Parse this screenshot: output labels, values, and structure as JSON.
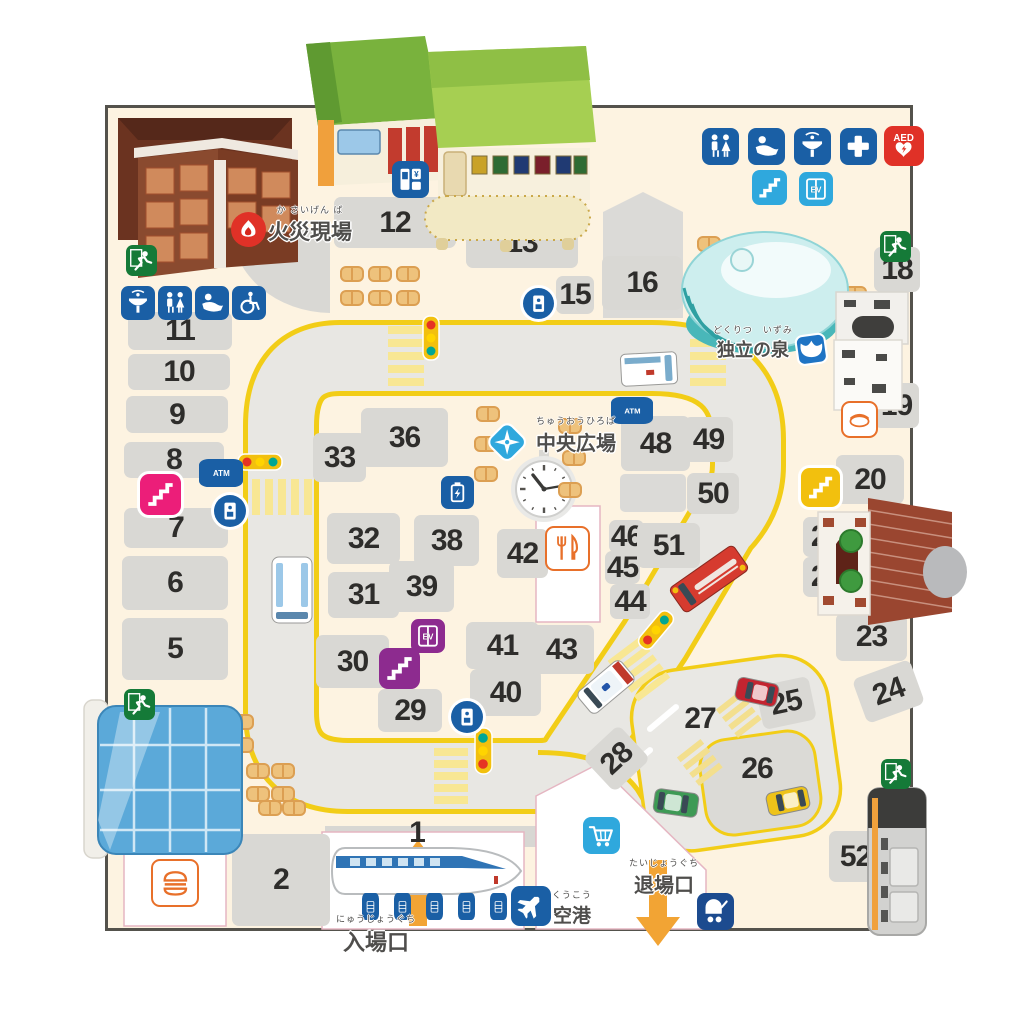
{
  "labels": {
    "fire": {
      "furigana": "か さいげん ば",
      "text": "火災現場"
    },
    "fountain": {
      "furigana": "どくりつ　いずみ",
      "text": "独立の泉"
    },
    "plaza": {
      "furigana": "ちゅうおうひろば",
      "text": "中央広場"
    },
    "entrance": {
      "furigana": "にゅうじょうぐち",
      "text": "入場口"
    },
    "exit": {
      "furigana": "たいじょうぐち",
      "text": "退場口"
    },
    "airport": {
      "furigana": "くうこう",
      "text": "空港"
    }
  },
  "board": {
    "colors": {
      "board_bg": "#fdf3e1",
      "cell_gray": "#d9d8d4",
      "road_gray": "#e8e7e3",
      "road_line_yellow": "#f2cd17",
      "crosswalk_yellow": "#f8e793",
      "icon_blue": "#1a5fa5",
      "icon_lightblue": "#2fa8dd",
      "icon_navy": "#1c4b8f",
      "icon_purple": "#8d2b8f",
      "icon_pink": "#ec1e79",
      "icon_yellow": "#f2c00e",
      "exit_green": "#157a38",
      "aed_red": "#e03127",
      "accent_orange": "#f2a434",
      "chip_orange": "#e8702a",
      "zone_border_pink": "#e5b6c2"
    },
    "spaces": [
      {
        "n": "1",
        "bare": true,
        "cx": 417,
        "cy": 833
      },
      {
        "n": "2",
        "x": 232,
        "y": 834,
        "w": 98,
        "h": 92
      },
      {
        "n": "3",
        "x": 138,
        "y": 790,
        "w": 58,
        "h": 42
      },
      {
        "n": "4",
        "x": 140,
        "y": 716,
        "w": 62,
        "h": 48
      },
      {
        "n": "5",
        "x": 122,
        "y": 618,
        "w": 106,
        "h": 62
      },
      {
        "n": "6",
        "x": 122,
        "y": 556,
        "w": 106,
        "h": 54
      },
      {
        "n": "7",
        "x": 124,
        "y": 508,
        "w": 104,
        "h": 40
      },
      {
        "n": "8",
        "x": 124,
        "y": 442,
        "w": 100,
        "h": 36
      },
      {
        "n": "9",
        "x": 126,
        "y": 396,
        "w": 102,
        "h": 37
      },
      {
        "n": "10",
        "x": 128,
        "y": 354,
        "w": 102,
        "h": 36
      },
      {
        "n": "11",
        "x": 128,
        "y": 312,
        "w": 104,
        "h": 38
      },
      {
        "n": "12",
        "x": 334,
        "y": 197,
        "w": 122,
        "h": 51
      },
      {
        "n": "13",
        "x": 466,
        "y": 218,
        "w": 112,
        "h": 50
      },
      {
        "n": "15",
        "x": 556,
        "y": 276,
        "w": 38,
        "h": 38
      },
      {
        "n": "16",
        "x": 602,
        "y": 256,
        "w": 80,
        "h": 54
      },
      {
        "n": "18",
        "x": 874,
        "y": 247,
        "w": 46,
        "h": 45
      },
      {
        "n": "19",
        "x": 874,
        "y": 383,
        "w": 45,
        "h": 45
      },
      {
        "n": "20",
        "x": 836,
        "y": 455,
        "w": 68,
        "h": 49
      },
      {
        "n": "21",
        "x": 803,
        "y": 517,
        "w": 47,
        "h": 40
      },
      {
        "n": "22",
        "x": 803,
        "y": 557,
        "w": 47,
        "h": 40
      },
      {
        "n": "23",
        "x": 836,
        "y": 613,
        "w": 71,
        "h": 48
      },
      {
        "n": "24",
        "x": 858,
        "y": 668,
        "w": 61,
        "h": 47,
        "rot": -20
      },
      {
        "n": "25",
        "x": 759,
        "y": 681,
        "w": 54,
        "h": 44,
        "rot": -12
      },
      {
        "n": "26",
        "bare": true,
        "cx": 757,
        "cy": 769
      },
      {
        "n": "27",
        "bare": true,
        "cx": 700,
        "cy": 719
      },
      {
        "n": "28",
        "x": 592,
        "y": 735,
        "w": 49,
        "h": 47,
        "rot": -43
      },
      {
        "n": "29",
        "x": 378,
        "y": 689,
        "w": 64,
        "h": 43
      },
      {
        "n": "30",
        "x": 316,
        "y": 635,
        "w": 73,
        "h": 53
      },
      {
        "n": "31",
        "x": 328,
        "y": 572,
        "w": 71,
        "h": 46
      },
      {
        "n": "32",
        "x": 327,
        "y": 513,
        "w": 73,
        "h": 51
      },
      {
        "n": "33",
        "x": 313,
        "y": 433,
        "w": 53,
        "h": 49
      },
      {
        "n": "36",
        "x": 361,
        "y": 408,
        "w": 87,
        "h": 59
      },
      {
        "n": "38",
        "x": 414,
        "y": 515,
        "w": 65,
        "h": 51
      },
      {
        "n": "39",
        "x": 389,
        "y": 561,
        "w": 65,
        "h": 51
      },
      {
        "n": "40",
        "x": 470,
        "y": 669,
        "w": 71,
        "h": 47
      },
      {
        "n": "41",
        "x": 466,
        "y": 622,
        "w": 73,
        "h": 47
      },
      {
        "n": "42",
        "x": 497,
        "y": 529,
        "w": 51,
        "h": 49
      },
      {
        "n": "43",
        "x": 529,
        "y": 625,
        "w": 65,
        "h": 49
      },
      {
        "n": "44",
        "x": 610,
        "y": 584,
        "w": 40,
        "h": 35
      },
      {
        "n": "45",
        "x": 605,
        "y": 551,
        "w": 35,
        "h": 33
      },
      {
        "n": "46",
        "x": 609,
        "y": 520,
        "w": 35,
        "h": 33
      },
      {
        "n": "48",
        "x": 621,
        "y": 416,
        "w": 69,
        "h": 55
      },
      {
        "n": "49",
        "x": 684,
        "y": 417,
        "w": 49,
        "h": 45
      },
      {
        "n": "50",
        "x": 687,
        "y": 473,
        "w": 52,
        "h": 41
      },
      {
        "n": "51",
        "x": 637,
        "y": 523,
        "w": 63,
        "h": 45
      },
      {
        "n": "52",
        "x": 829,
        "y": 831,
        "w": 53,
        "h": 51
      }
    ],
    "icons": [
      {
        "t": "toilet",
        "x": 702,
        "y": 128,
        "s": 37
      },
      {
        "t": "nursing",
        "x": 748,
        "y": 128,
        "s": 37
      },
      {
        "t": "drink-fountain",
        "x": 794,
        "y": 128,
        "s": 37
      },
      {
        "t": "first-aid",
        "x": 840,
        "y": 128,
        "s": 37
      },
      {
        "t": "aed",
        "x": 884,
        "y": 126,
        "s": 40,
        "bg": "red"
      },
      {
        "t": "stairs",
        "x": 752,
        "y": 170,
        "s": 35,
        "bg": "lightblue"
      },
      {
        "t": "elevator",
        "x": 799,
        "y": 172,
        "s": 34,
        "bg": "lightblue"
      },
      {
        "t": "exit-run",
        "x": 880,
        "y": 231,
        "s": 31,
        "bg": "green"
      },
      {
        "t": "exit-run",
        "x": 126,
        "y": 245,
        "s": 31,
        "bg": "green"
      },
      {
        "t": "drink-fountain",
        "x": 121,
        "y": 286,
        "s": 34
      },
      {
        "t": "toilet",
        "x": 158,
        "y": 286,
        "s": 34
      },
      {
        "t": "nursing",
        "x": 195,
        "y": 286,
        "s": 34
      },
      {
        "t": "wheelchair",
        "x": 232,
        "y": 286,
        "s": 34
      },
      {
        "t": "fire-badge",
        "x": 231,
        "y": 212,
        "s": 35,
        "bg": "red"
      },
      {
        "t": "vending",
        "x": 392,
        "y": 161,
        "s": 37
      },
      {
        "t": "phone",
        "x": 523,
        "y": 288,
        "s": 31
      },
      {
        "t": "atm",
        "x": 199,
        "y": 459,
        "w": 44,
        "h": 28
      },
      {
        "t": "stairs",
        "x": 140,
        "y": 474,
        "s": 41,
        "bg": "pink",
        "ring": true
      },
      {
        "t": "phone",
        "x": 214,
        "y": 495,
        "s": 32
      },
      {
        "t": "battery",
        "x": 441,
        "y": 476,
        "s": 33
      },
      {
        "t": "atm",
        "x": 611,
        "y": 397,
        "w": 42,
        "h": 27
      },
      {
        "t": "compass",
        "x": 483,
        "y": 418,
        "s": 48,
        "bg": "none"
      },
      {
        "t": "izumi",
        "x": 789,
        "y": 327,
        "s": 44,
        "bg": "none"
      },
      {
        "t": "fork-knife",
        "x": 545,
        "y": 526,
        "s": 45,
        "bg": "chip"
      },
      {
        "t": "hotdog",
        "x": 841,
        "y": 401,
        "s": 37,
        "bg": "chip"
      },
      {
        "t": "burger",
        "x": 151,
        "y": 859,
        "s": 48,
        "bg": "chip"
      },
      {
        "t": "elevator",
        "x": 411,
        "y": 619,
        "s": 34,
        "bg": "purple"
      },
      {
        "t": "stairs",
        "x": 379,
        "y": 648,
        "s": 41,
        "bg": "purple"
      },
      {
        "t": "stairs",
        "x": 801,
        "y": 468,
        "s": 39,
        "bg": "yellow",
        "ring": true
      },
      {
        "t": "exit-run",
        "x": 124,
        "y": 689,
        "s": 31,
        "bg": "green"
      },
      {
        "t": "exit-run",
        "x": 881,
        "y": 759,
        "s": 30,
        "bg": "green"
      },
      {
        "t": "phone",
        "x": 451,
        "y": 701,
        "s": 32
      },
      {
        "t": "plane",
        "x": 511,
        "y": 886,
        "s": 40
      },
      {
        "t": "cart",
        "x": 583,
        "y": 817,
        "s": 37,
        "bg": "lightblue"
      },
      {
        "t": "stroller",
        "x": 697,
        "y": 893,
        "s": 37,
        "bg": "navy"
      },
      {
        "t": "gate",
        "x": 362,
        "y": 893,
        "w": 17,
        "h": 27
      },
      {
        "t": "gate",
        "x": 394,
        "y": 893,
        "w": 17,
        "h": 27
      },
      {
        "t": "gate",
        "x": 426,
        "y": 893,
        "w": 17,
        "h": 27
      },
      {
        "t": "gate",
        "x": 458,
        "y": 893,
        "w": 17,
        "h": 27
      },
      {
        "t": "gate",
        "x": 490,
        "y": 893,
        "w": 17,
        "h": 27
      }
    ],
    "vehicles": [
      {
        "t": "ambulance",
        "x": 649,
        "y": 369,
        "w": 56,
        "h": 32,
        "r": -3
      },
      {
        "t": "bus",
        "x": 292,
        "y": 590,
        "w": 66,
        "h": 40,
        "r": 90
      },
      {
        "t": "firetruck",
        "x": 709,
        "y": 579,
        "w": 78,
        "h": 30,
        "r": 145
      },
      {
        "t": "police",
        "x": 606,
        "y": 687,
        "w": 56,
        "h": 28,
        "r": 140
      },
      {
        "t": "car",
        "x": 757,
        "y": 692,
        "w": 42,
        "h": 23,
        "r": 192,
        "c": "#c32430"
      },
      {
        "t": "car",
        "x": 676,
        "y": 803,
        "w": 44,
        "h": 24,
        "r": 8,
        "c": "#3e9a55"
      },
      {
        "t": "car",
        "x": 788,
        "y": 801,
        "w": 42,
        "h": 23,
        "r": 168,
        "c": "#eec319"
      }
    ],
    "tables": [
      [
        340,
        266
      ],
      [
        368,
        266
      ],
      [
        396,
        266
      ],
      [
        340,
        290
      ],
      [
        368,
        290
      ],
      [
        396,
        290
      ],
      [
        697,
        236
      ],
      [
        686,
        288
      ],
      [
        843,
        286
      ],
      [
        476,
        406
      ],
      [
        474,
        436
      ],
      [
        474,
        466
      ],
      [
        558,
        418
      ],
      [
        562,
        450
      ],
      [
        558,
        482
      ],
      [
        205,
        714
      ],
      [
        230,
        714
      ],
      [
        205,
        737
      ],
      [
        230,
        737
      ],
      [
        246,
        763
      ],
      [
        271,
        763
      ],
      [
        246,
        786
      ],
      [
        271,
        786
      ],
      [
        258,
        800
      ],
      [
        282,
        800
      ]
    ]
  }
}
